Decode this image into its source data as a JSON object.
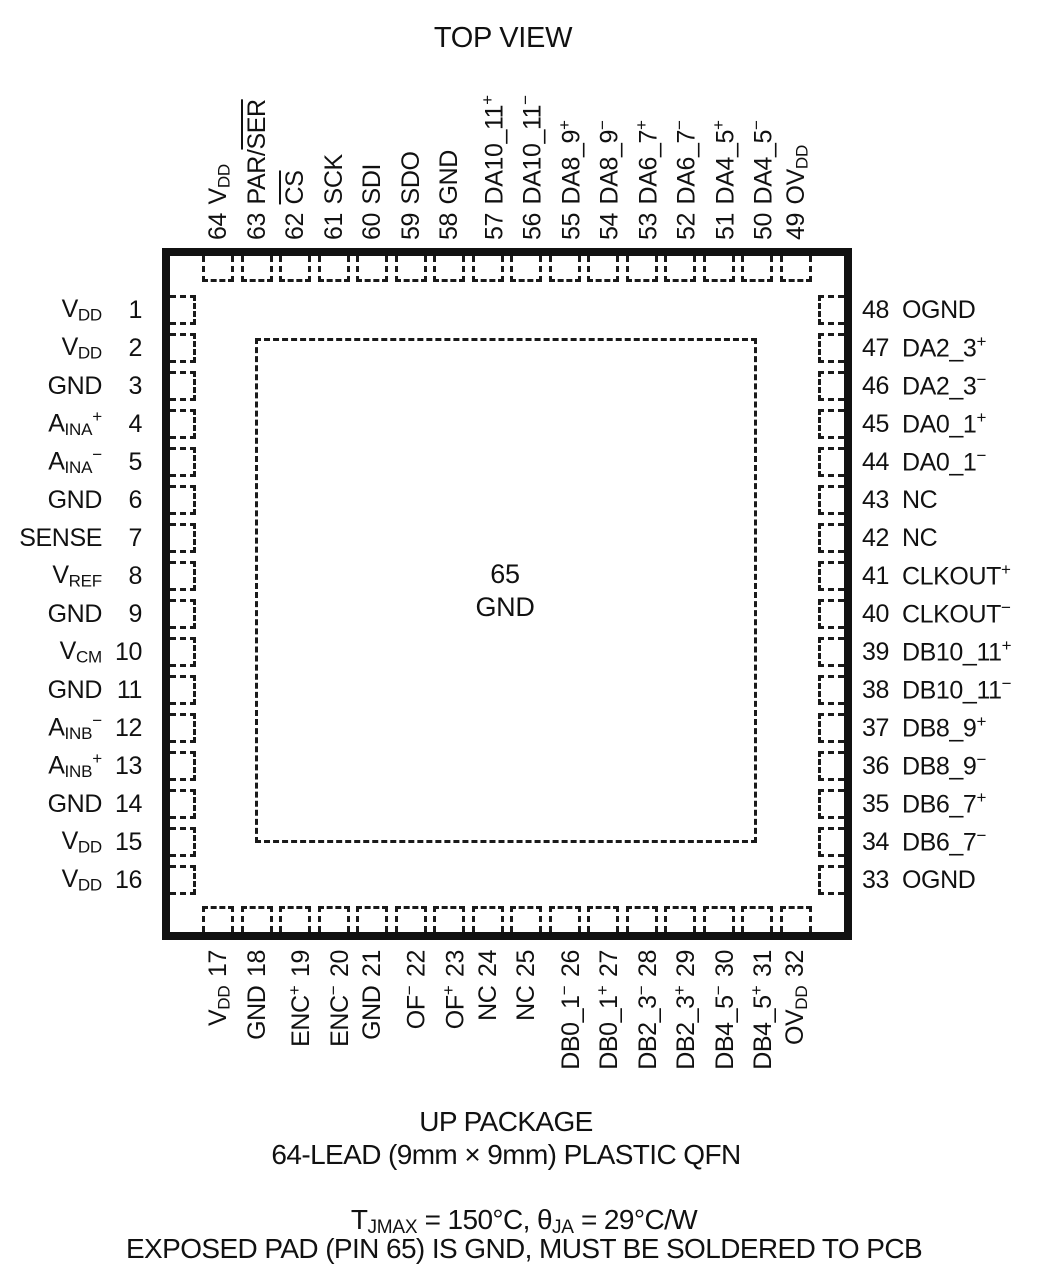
{
  "title": "TOP VIEW",
  "center_pad": {
    "number": "65",
    "name": "GND"
  },
  "pins": {
    "left": [
      {
        "num": "1",
        "name": "V~DD~"
      },
      {
        "num": "2",
        "name": "V~DD~"
      },
      {
        "num": "3",
        "name": "GND"
      },
      {
        "num": "4",
        "name": "A~INA~^+^"
      },
      {
        "num": "5",
        "name": "A~INA~^−^"
      },
      {
        "num": "6",
        "name": "GND"
      },
      {
        "num": "7",
        "name": "SENSE"
      },
      {
        "num": "8",
        "name": "V~REF~"
      },
      {
        "num": "9",
        "name": "GND"
      },
      {
        "num": "10",
        "name": "V~CM~"
      },
      {
        "num": "11",
        "name": "GND"
      },
      {
        "num": "12",
        "name": "A~INB~^−^"
      },
      {
        "num": "13",
        "name": "A~INB~^+^"
      },
      {
        "num": "14",
        "name": "GND"
      },
      {
        "num": "15",
        "name": "V~DD~"
      },
      {
        "num": "16",
        "name": "V~DD~"
      }
    ],
    "top": [
      {
        "num": "64",
        "name": "V~DD~"
      },
      {
        "num": "63",
        "name": "PAR/`SER`"
      },
      {
        "num": "62",
        "name": "`CS`"
      },
      {
        "num": "61",
        "name": "SCK"
      },
      {
        "num": "60",
        "name": "SDI"
      },
      {
        "num": "59",
        "name": "SDO"
      },
      {
        "num": "58",
        "name": "GND"
      },
      {
        "num": "57",
        "name": "DA10_11^+^"
      },
      {
        "num": "56",
        "name": "DA10_11^−^"
      },
      {
        "num": "55",
        "name": "DA8_9^+^"
      },
      {
        "num": "54",
        "name": "DA8_9^−^"
      },
      {
        "num": "53",
        "name": "DA6_7^+^"
      },
      {
        "num": "52",
        "name": "DA6_7^−^"
      },
      {
        "num": "51",
        "name": "DA4_5^+^"
      },
      {
        "num": "50",
        "name": "DA4_5^−^"
      },
      {
        "num": "49",
        "name": "OV~DD~"
      }
    ],
    "right": [
      {
        "num": "48",
        "name": "OGND"
      },
      {
        "num": "47",
        "name": "DA2_3^+^"
      },
      {
        "num": "46",
        "name": "DA2_3^−^"
      },
      {
        "num": "45",
        "name": "DA0_1^+^"
      },
      {
        "num": "44",
        "name": "DA0_1^−^"
      },
      {
        "num": "43",
        "name": "NC"
      },
      {
        "num": "42",
        "name": "NC"
      },
      {
        "num": "41",
        "name": "CLKOUT^+^"
      },
      {
        "num": "40",
        "name": "CLKOUT^−^"
      },
      {
        "num": "39",
        "name": "DB10_11^+^"
      },
      {
        "num": "38",
        "name": "DB10_11^−^"
      },
      {
        "num": "37",
        "name": "DB8_9^+^"
      },
      {
        "num": "36",
        "name": "DB8_9^−^"
      },
      {
        "num": "35",
        "name": "DB6_7^+^"
      },
      {
        "num": "34",
        "name": "DB6_7^−^"
      },
      {
        "num": "33",
        "name": "OGND"
      }
    ],
    "bottom": [
      {
        "num": "17",
        "name": "V~DD~"
      },
      {
        "num": "18",
        "name": "GND"
      },
      {
        "num": "19",
        "name": "ENC^+^"
      },
      {
        "num": "20",
        "name": "ENC^−^"
      },
      {
        "num": "21",
        "name": "GND"
      },
      {
        "num": "22",
        "name": "OF^−^"
      },
      {
        "num": "23",
        "name": "OF^+^"
      },
      {
        "num": "24",
        "name": "NC"
      },
      {
        "num": "25",
        "name": "NC"
      },
      {
        "num": "26",
        "name": "DB0_1^−^"
      },
      {
        "num": "27",
        "name": "DB0_1^+^"
      },
      {
        "num": "28",
        "name": "DB2_3^−^"
      },
      {
        "num": "29",
        "name": "DB2_3^+^"
      },
      {
        "num": "30",
        "name": "DB4_5^−^"
      },
      {
        "num": "31",
        "name": "DB4_5^+^"
      },
      {
        "num": "32",
        "name": "OV~DD~"
      }
    ]
  },
  "footer": {
    "package_name": "UP PACKAGE",
    "package_desc": "64-LEAD (9mm × 9mm) PLASTIC QFN",
    "thermal": "T~JMAX~ = 150°C, θ~JA~ = 29°C/W",
    "note": "EXPOSED PAD (PIN 65) IS GND, MUST BE SOLDERED TO PCB"
  },
  "colors": {
    "ink": "#111111",
    "bg": "#ffffff"
  }
}
